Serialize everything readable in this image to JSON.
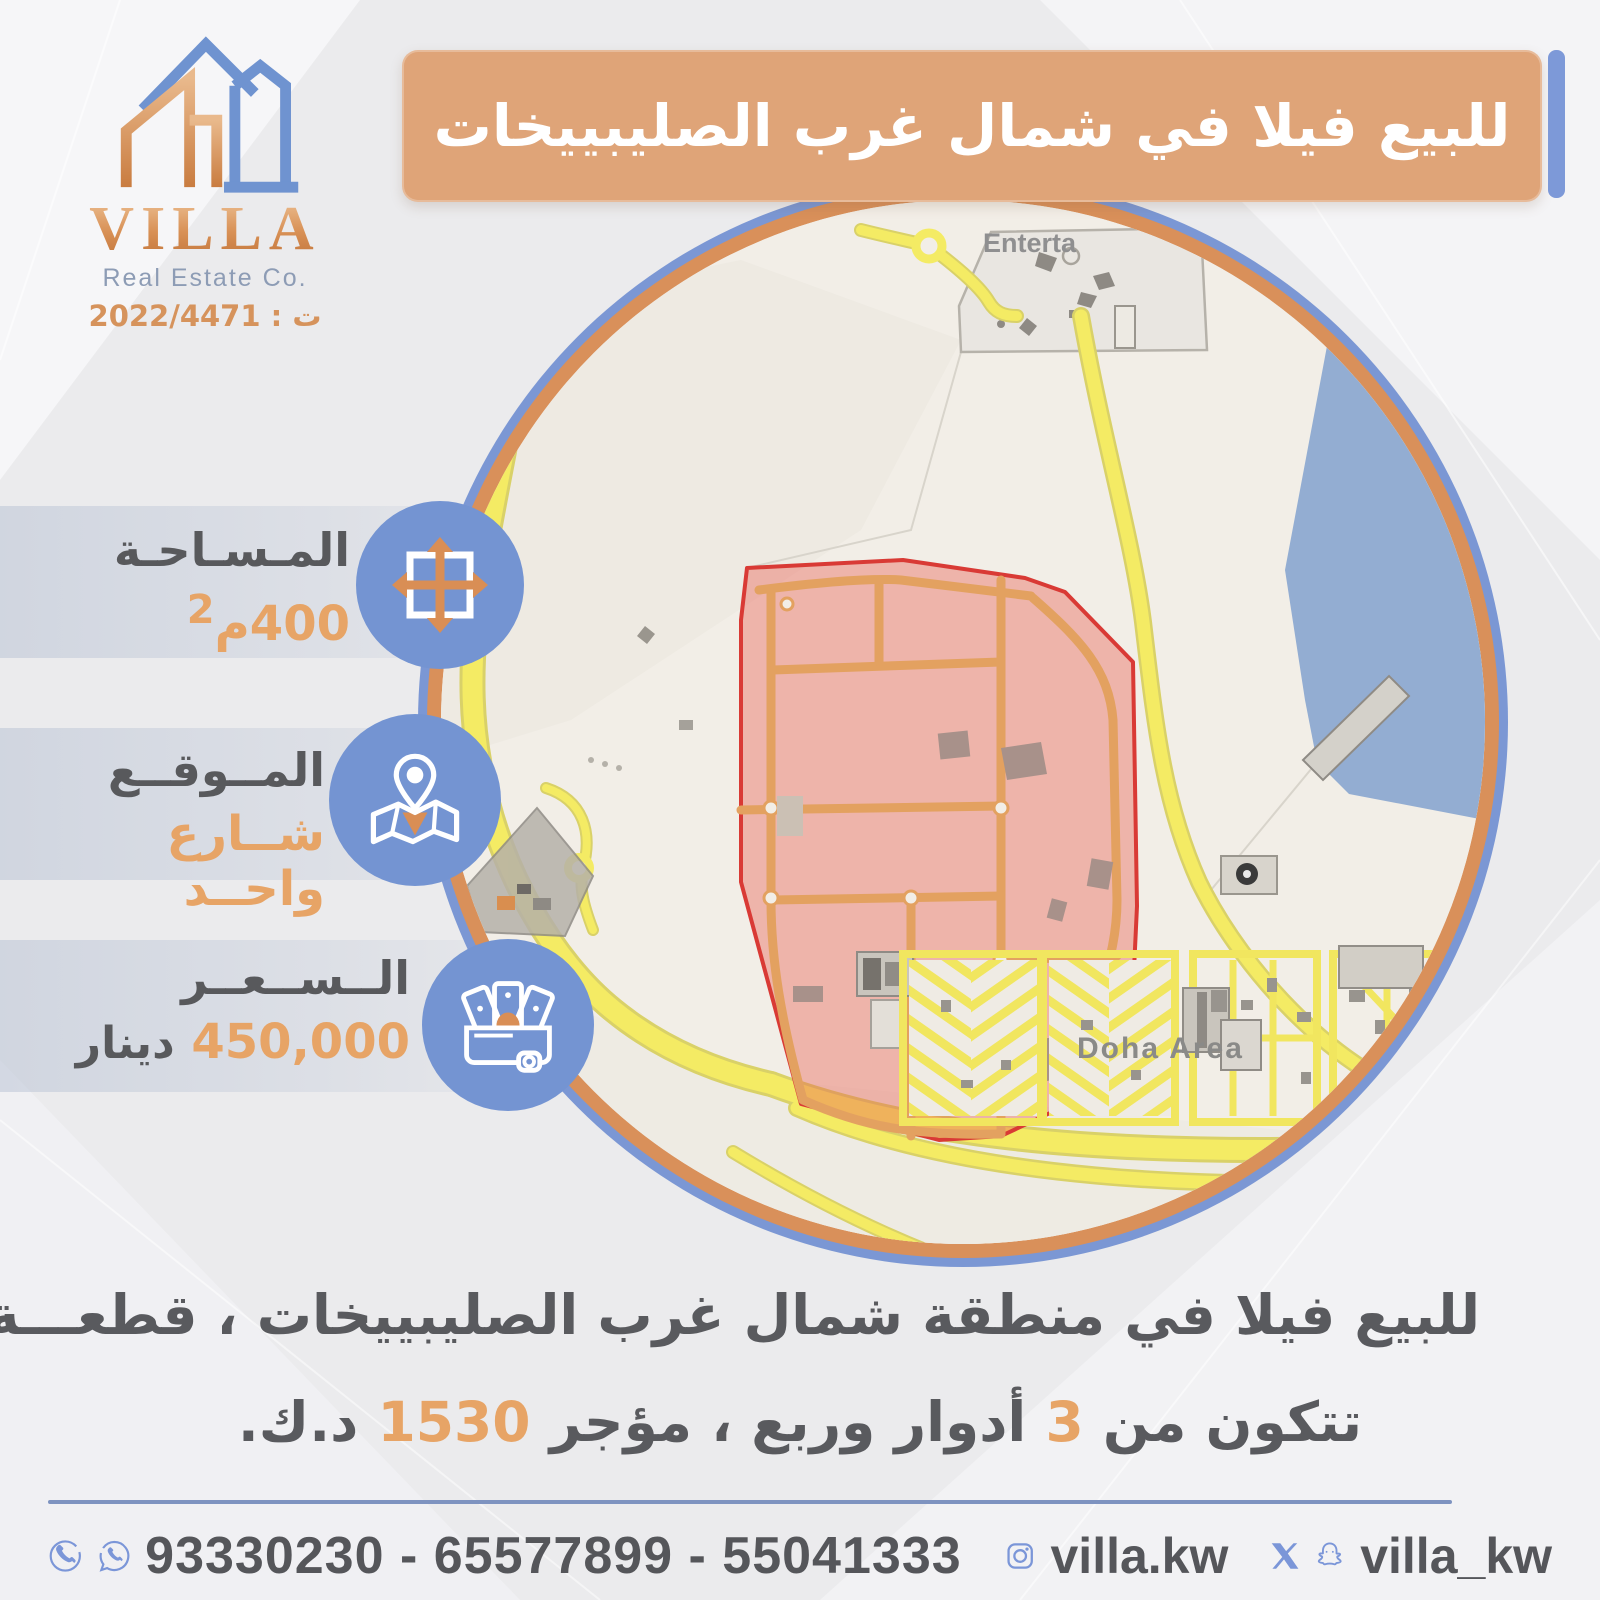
{
  "logo": {
    "title": "VILLA",
    "subtitle": "Real Estate Co.",
    "license": "ت : 2022/4471"
  },
  "header": {
    "title": "للبيع فيلا في شمال غرب الصليبييخات"
  },
  "specs": {
    "area_label": "المـسـاحـة",
    "area_value": "400م",
    "area_sup": "2",
    "location_label": "المــوقــع",
    "location_value": "شــارع واحــد",
    "price_label": "الــســعــر",
    "price_value": "450,000",
    "price_unit": "دينار"
  },
  "map": {
    "top_label": "Enterta",
    "area_label": "Doha Area"
  },
  "description": {
    "line1_text": "للبيع فيلا في منطقة شمال غرب الصليبييخات ، قطعـــة ",
    "line1_num": "1",
    "line2_part1": "تتكون من ",
    "line2_num1": "3",
    "line2_part2": " أدوار وربع ، مؤجر ",
    "line2_num2": "1530",
    "line2_part3": " د.ك."
  },
  "footer": {
    "phones": "93330230 - 65577899 - 55041333",
    "instagram": "villa.kw",
    "social_handle": "villa_kw"
  },
  "icons": {
    "area": "move-arrows-icon",
    "location": "map-pin-icon",
    "price": "cash-icon",
    "phone": "phone-icon",
    "whatsapp": "whatsapp-icon",
    "instagram": "instagram-icon",
    "x": "x-icon",
    "snapchat": "snapchat-icon"
  },
  "colors": {
    "banner_orange": "#dfa478",
    "ring_orange": "#d9905a",
    "accent_blue": "#7b96d8",
    "icon_blue": "#7494d2",
    "text_dark": "#58595c",
    "text_orange": "#e7a466",
    "map_highlight_stroke": "#d93a35",
    "map_water": "#93add2",
    "map_road_yellow": "#f4eb64"
  }
}
